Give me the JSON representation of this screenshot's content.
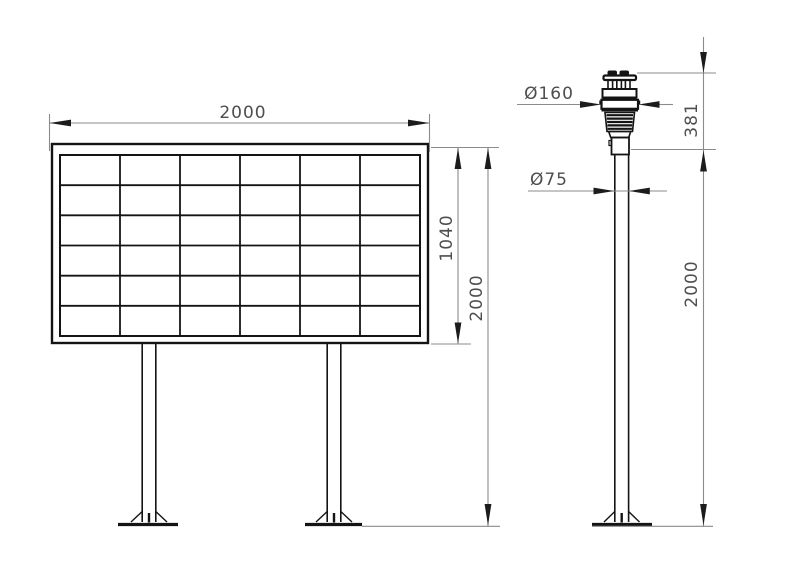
{
  "views": {
    "board": {
      "name": "display-board-front-view",
      "grid_rows": 6,
      "grid_cols": 6,
      "dims": {
        "width": "2000",
        "panel_height": "1040",
        "total_height": "2000"
      }
    },
    "pole": {
      "name": "weather-sensor-pole-side-view",
      "dims": {
        "sensor_diameter": "Ø160",
        "pole_diameter": "Ø75",
        "sensor_height": "381",
        "pole_height": "2000"
      }
    }
  },
  "colors": {
    "background": "#ffffff",
    "object_line": "#141414",
    "dim_line": "#8b8b8b",
    "dim_text": "#4e4e4e",
    "arrow": "#1c1c1c"
  }
}
